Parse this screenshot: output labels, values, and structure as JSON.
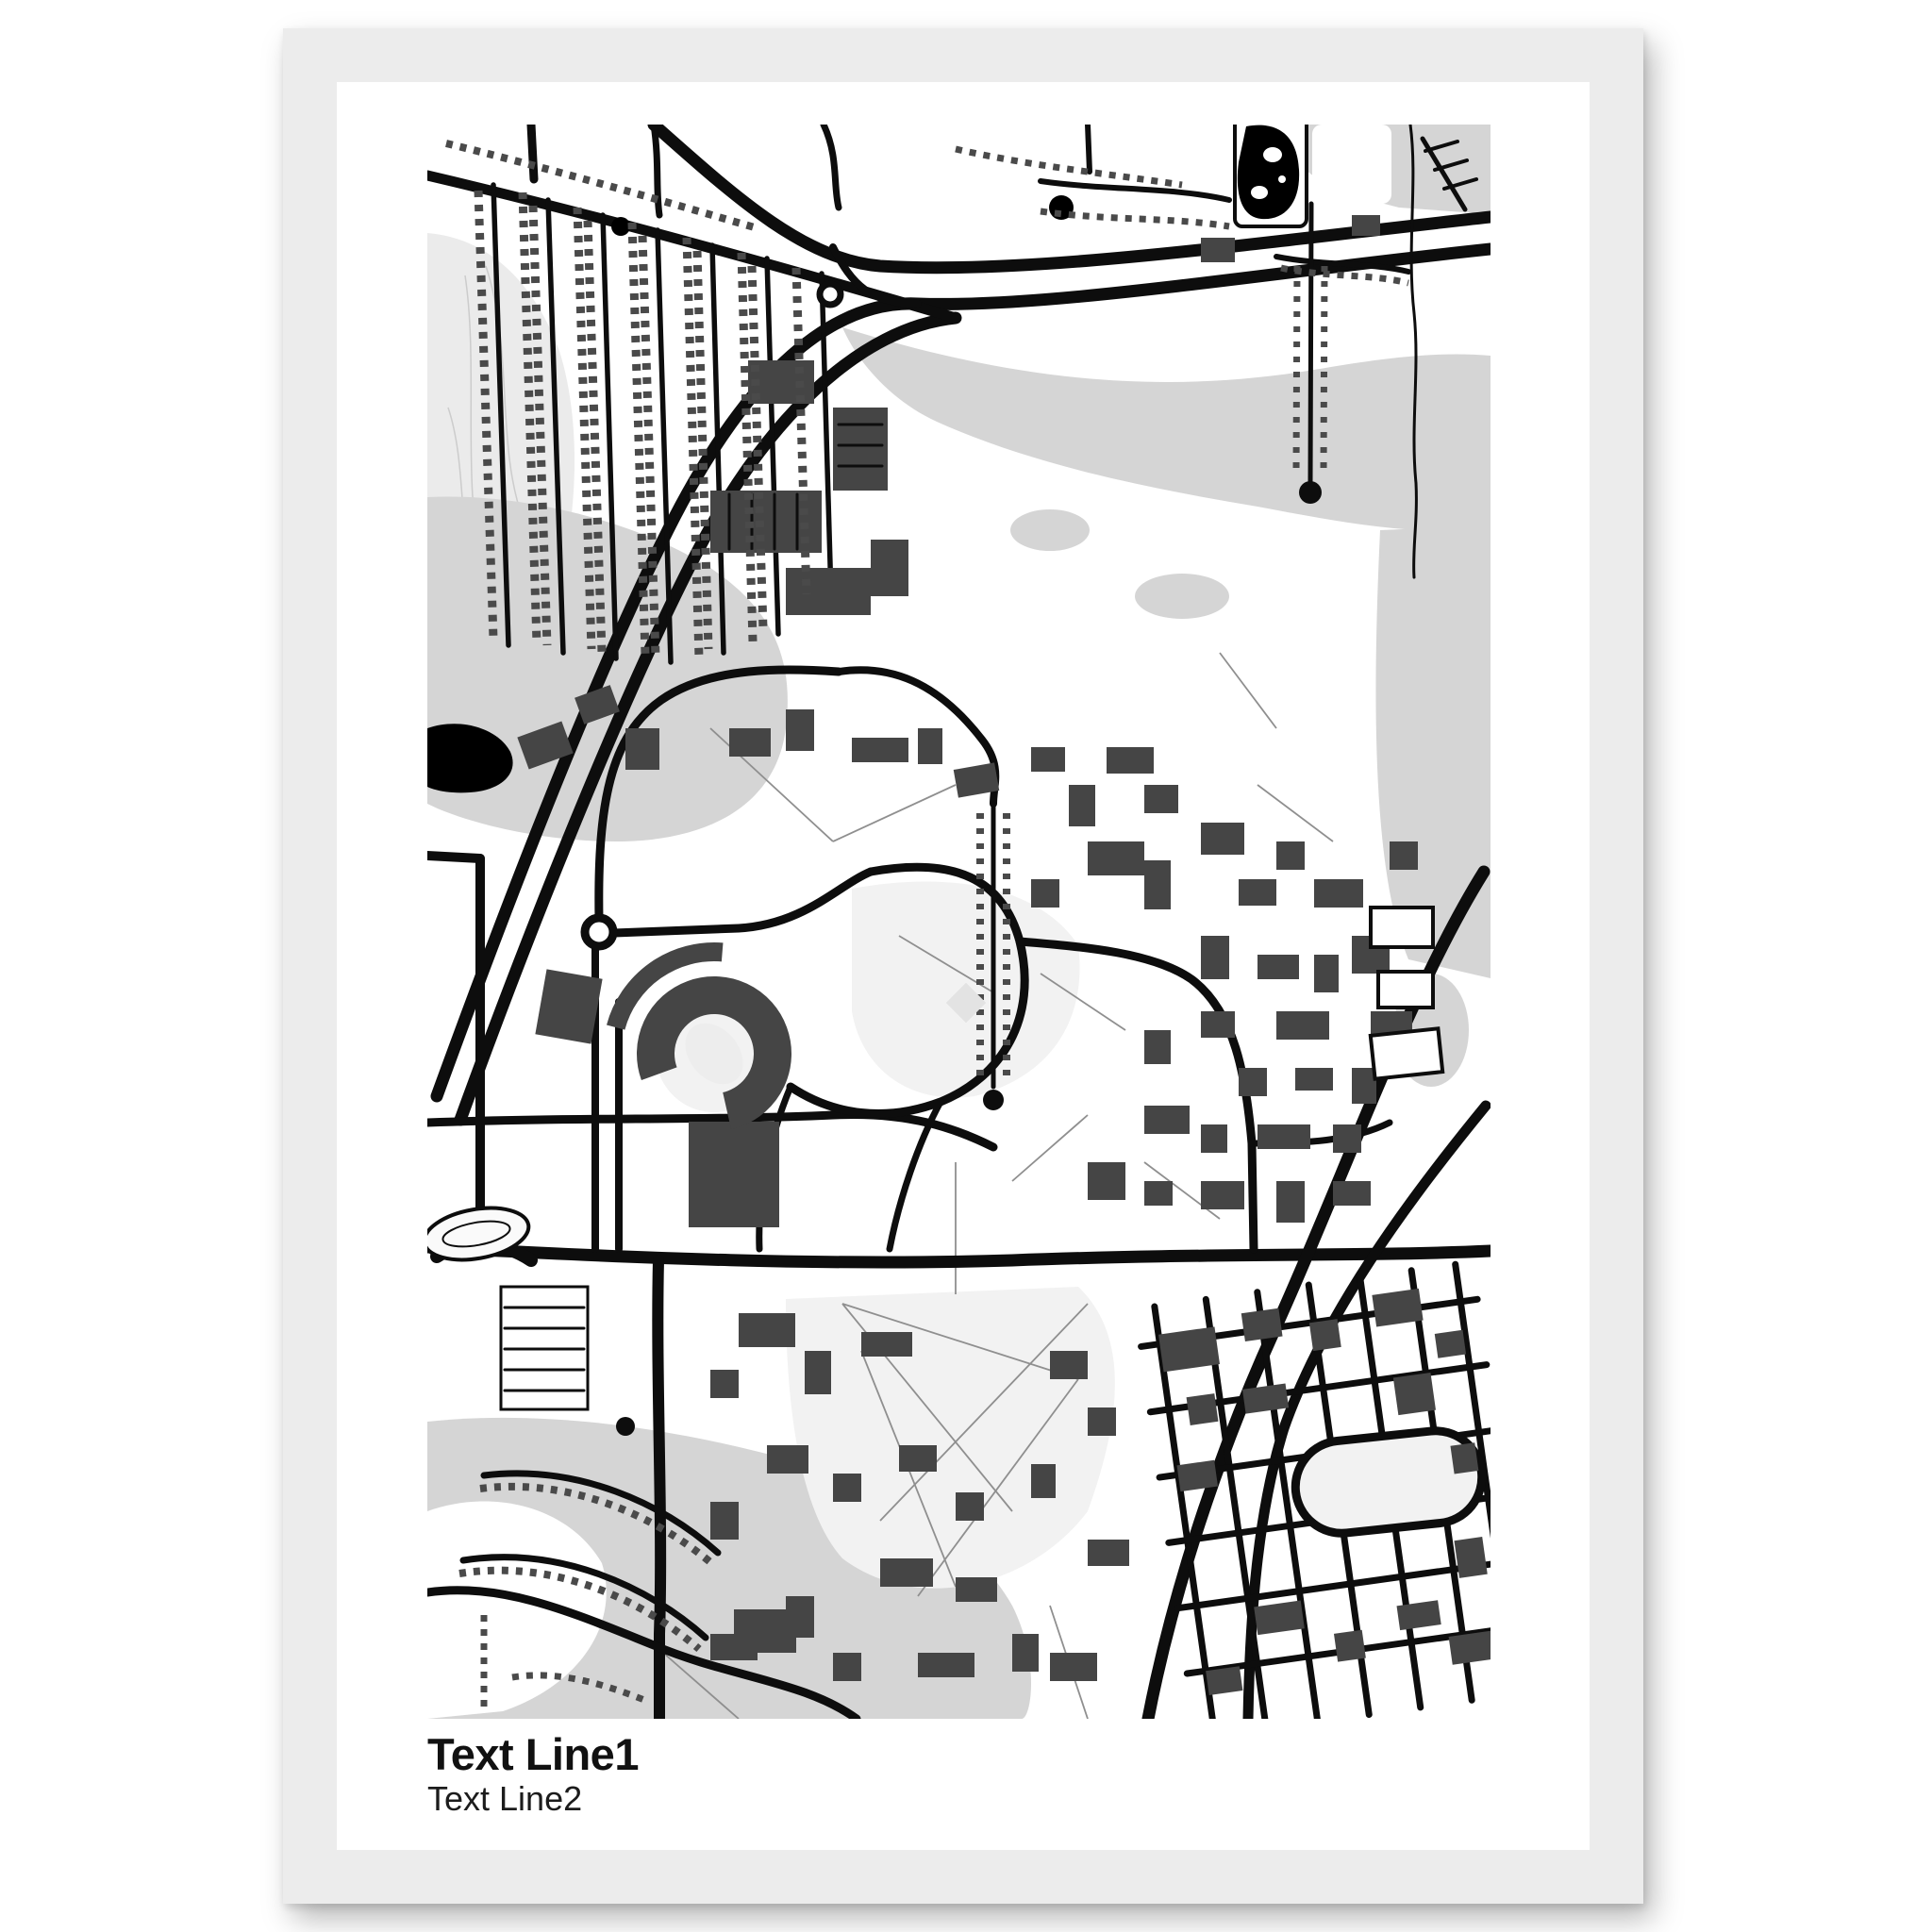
{
  "poster": {
    "title_line1": "Text Line1",
    "title_line2": "Text Line2",
    "title_color": "#111111"
  },
  "map": {
    "description": "monochrome street map artwork of a university campus and surrounding city",
    "features": [
      "freeway interchange",
      "residential grid",
      "horseshoe stadium",
      "campus quads",
      "ponds",
      "tree-lined mall",
      "loop road"
    ],
    "colors": {
      "background": "#ffffff",
      "land": "#d5d5d5",
      "land_light": "#ebebeb",
      "field": "#f2f2f2",
      "water": "#000000",
      "road": "#0d0d0d",
      "building": "#454545",
      "house": "#4a4a4a",
      "path": "#8f8f8f",
      "contour": "#cccccc"
    }
  },
  "mockup": {
    "page_background": "#ffffff",
    "frame_color": "#ececec",
    "paper_color": "#ffffff"
  }
}
